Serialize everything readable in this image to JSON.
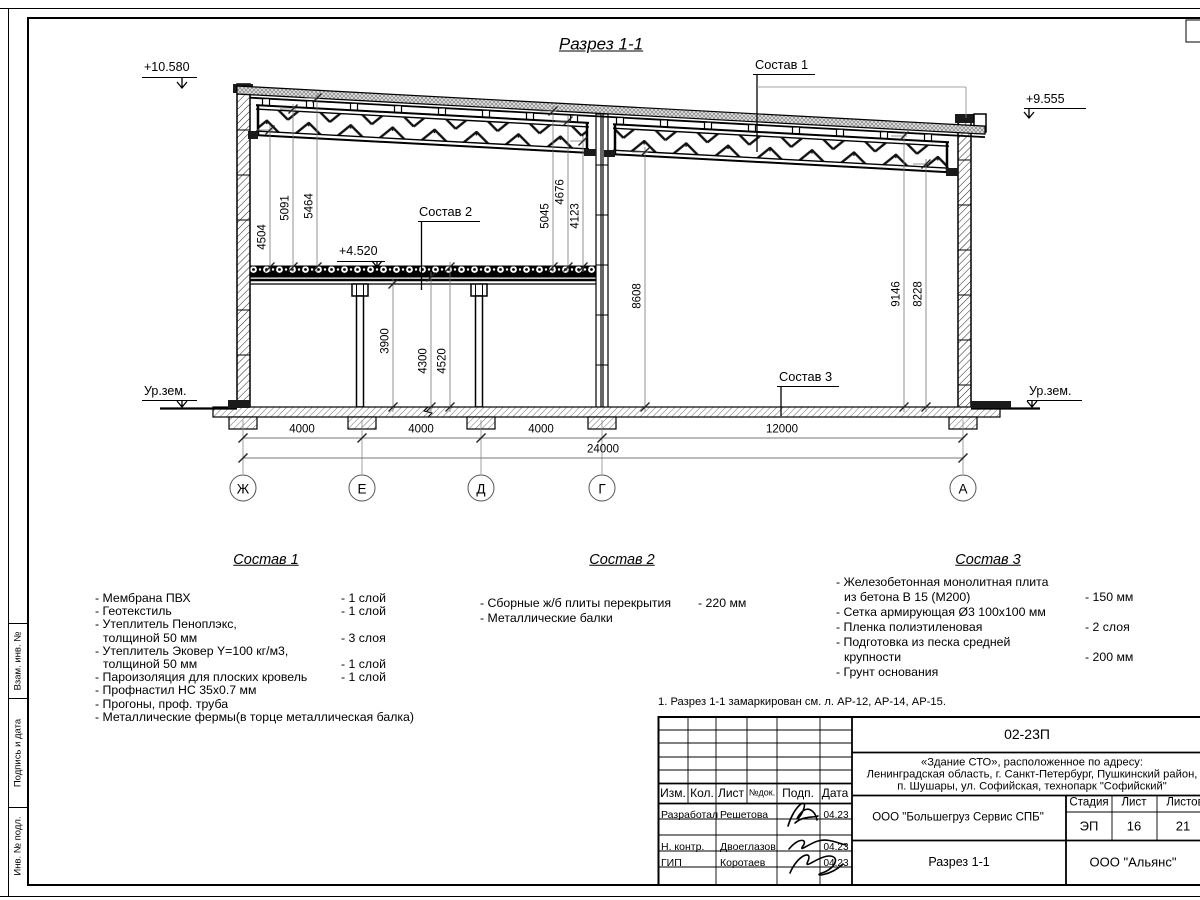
{
  "sheet": {
    "title": "Разрез 1-1",
    "note": "1. Разрез 1-1 замаркирован см. л. АР-12, АР-14, АР-15."
  },
  "elevations": {
    "left_top": "+10.580",
    "right_top": "+9.555",
    "slab": "+4.520",
    "ground_left": "Ур.зем.",
    "ground_right": "Ур.зем."
  },
  "leaders": {
    "s1": "Состав 1",
    "s2": "Состав 2",
    "s3": "Состав 3"
  },
  "dims": {
    "d4504": "4504",
    "d5091": "5091",
    "d5464": "5464",
    "d5045": "5045",
    "d4676": "4676",
    "d4123": "4123",
    "d8608": "8608",
    "d9146": "9146",
    "d8228": "8228",
    "d3900": "3900",
    "d4300": "4300",
    "d4520": "4520",
    "span1": "4000",
    "span2": "4000",
    "span3": "4000",
    "span4": "12000",
    "total": "24000"
  },
  "axes": [
    "Ж",
    "Е",
    "Д",
    "Г",
    "А"
  ],
  "spec1": {
    "title": "Состав 1",
    "items": [
      {
        "n": "- Мембрана ПВХ",
        "v": "- 1 слой"
      },
      {
        "n": "- Геотекстиль",
        "v": "- 1 слой"
      },
      {
        "n": "- Утеплитель Пеноплэкс,",
        "v": ""
      },
      {
        "n": "толщиной 50 мм",
        "v": "- 3 слоя"
      },
      {
        "n": "- Утеплитель Эковер Y=100 кг/м3,",
        "v": ""
      },
      {
        "n": "толщиной 50 мм",
        "v": "- 1 слой"
      },
      {
        "n": "- Пароизоляция для плоских кровель",
        "v": "- 1 слой"
      },
      {
        "n": "- Профнастил НС 35х0.7 мм",
        "v": ""
      },
      {
        "n": "- Прогоны, проф. труба",
        "v": ""
      },
      {
        "n": "- Металлические фермы(в торце металлическая балка)",
        "v": ""
      }
    ]
  },
  "spec2": {
    "title": "Состав 2",
    "items": [
      {
        "n": "- Сборные ж/б плиты перекрытия",
        "v": "- 220 мм"
      },
      {
        "n": "- Металлические балки",
        "v": ""
      }
    ]
  },
  "spec3": {
    "title": "Состав 3",
    "items": [
      {
        "n": "- Железобетонная  монолитная плита",
        "v": ""
      },
      {
        "n": "из бетона В 15 (М200)",
        "v": "- 150 мм"
      },
      {
        "n": "- Сетка армирующая Ø3 100х100 мм",
        "v": ""
      },
      {
        "n": "- Пленка полиэтиленовая",
        "v": "-  2 слоя"
      },
      {
        "n": "- Подготовка из песка средней",
        "v": ""
      },
      {
        "n": "крупности",
        "v": "- 200 мм"
      },
      {
        "n": "- Грунт основания",
        "v": ""
      }
    ]
  },
  "titleblock": {
    "code": "02-23П",
    "address1": "«Здание СТО», расположенное по адресу:",
    "address2": "Ленинградская область, г. Санкт-Петербург, Пушкинский район,",
    "address3": "п. Шушары, ул. Софийская, технопарк \"Софийский\"",
    "org": "ООО \"Большегруз Сервис СПБ\"",
    "doc_title": "Разрез 1-1",
    "company": "ООО \"Альянс\"",
    "headers": {
      "izm": "Изм.",
      "kol": "Кол.",
      "list": "Лист",
      "ndoc": "№док.",
      "podp": "Подп.",
      "data": "Дата"
    },
    "stage_label": "Стадия",
    "list_label": "Лист",
    "listov_label": "Листов",
    "stage": "ЭП",
    "sheet_no": "16",
    "sheets_total": "21",
    "rows": [
      {
        "role": "Разработал",
        "name": "Решетова",
        "date": "04.23"
      },
      {
        "role": "Н. контр.",
        "name": "Двоеглазов",
        "date": "04.23"
      },
      {
        "role": "ГИП",
        "name": "Коротаев",
        "date": "04.23"
      }
    ]
  },
  "sidestamp": {
    "b1": "Взам. инв. №",
    "b2": "Подпись и дата",
    "b3": "Инв. № подл."
  }
}
